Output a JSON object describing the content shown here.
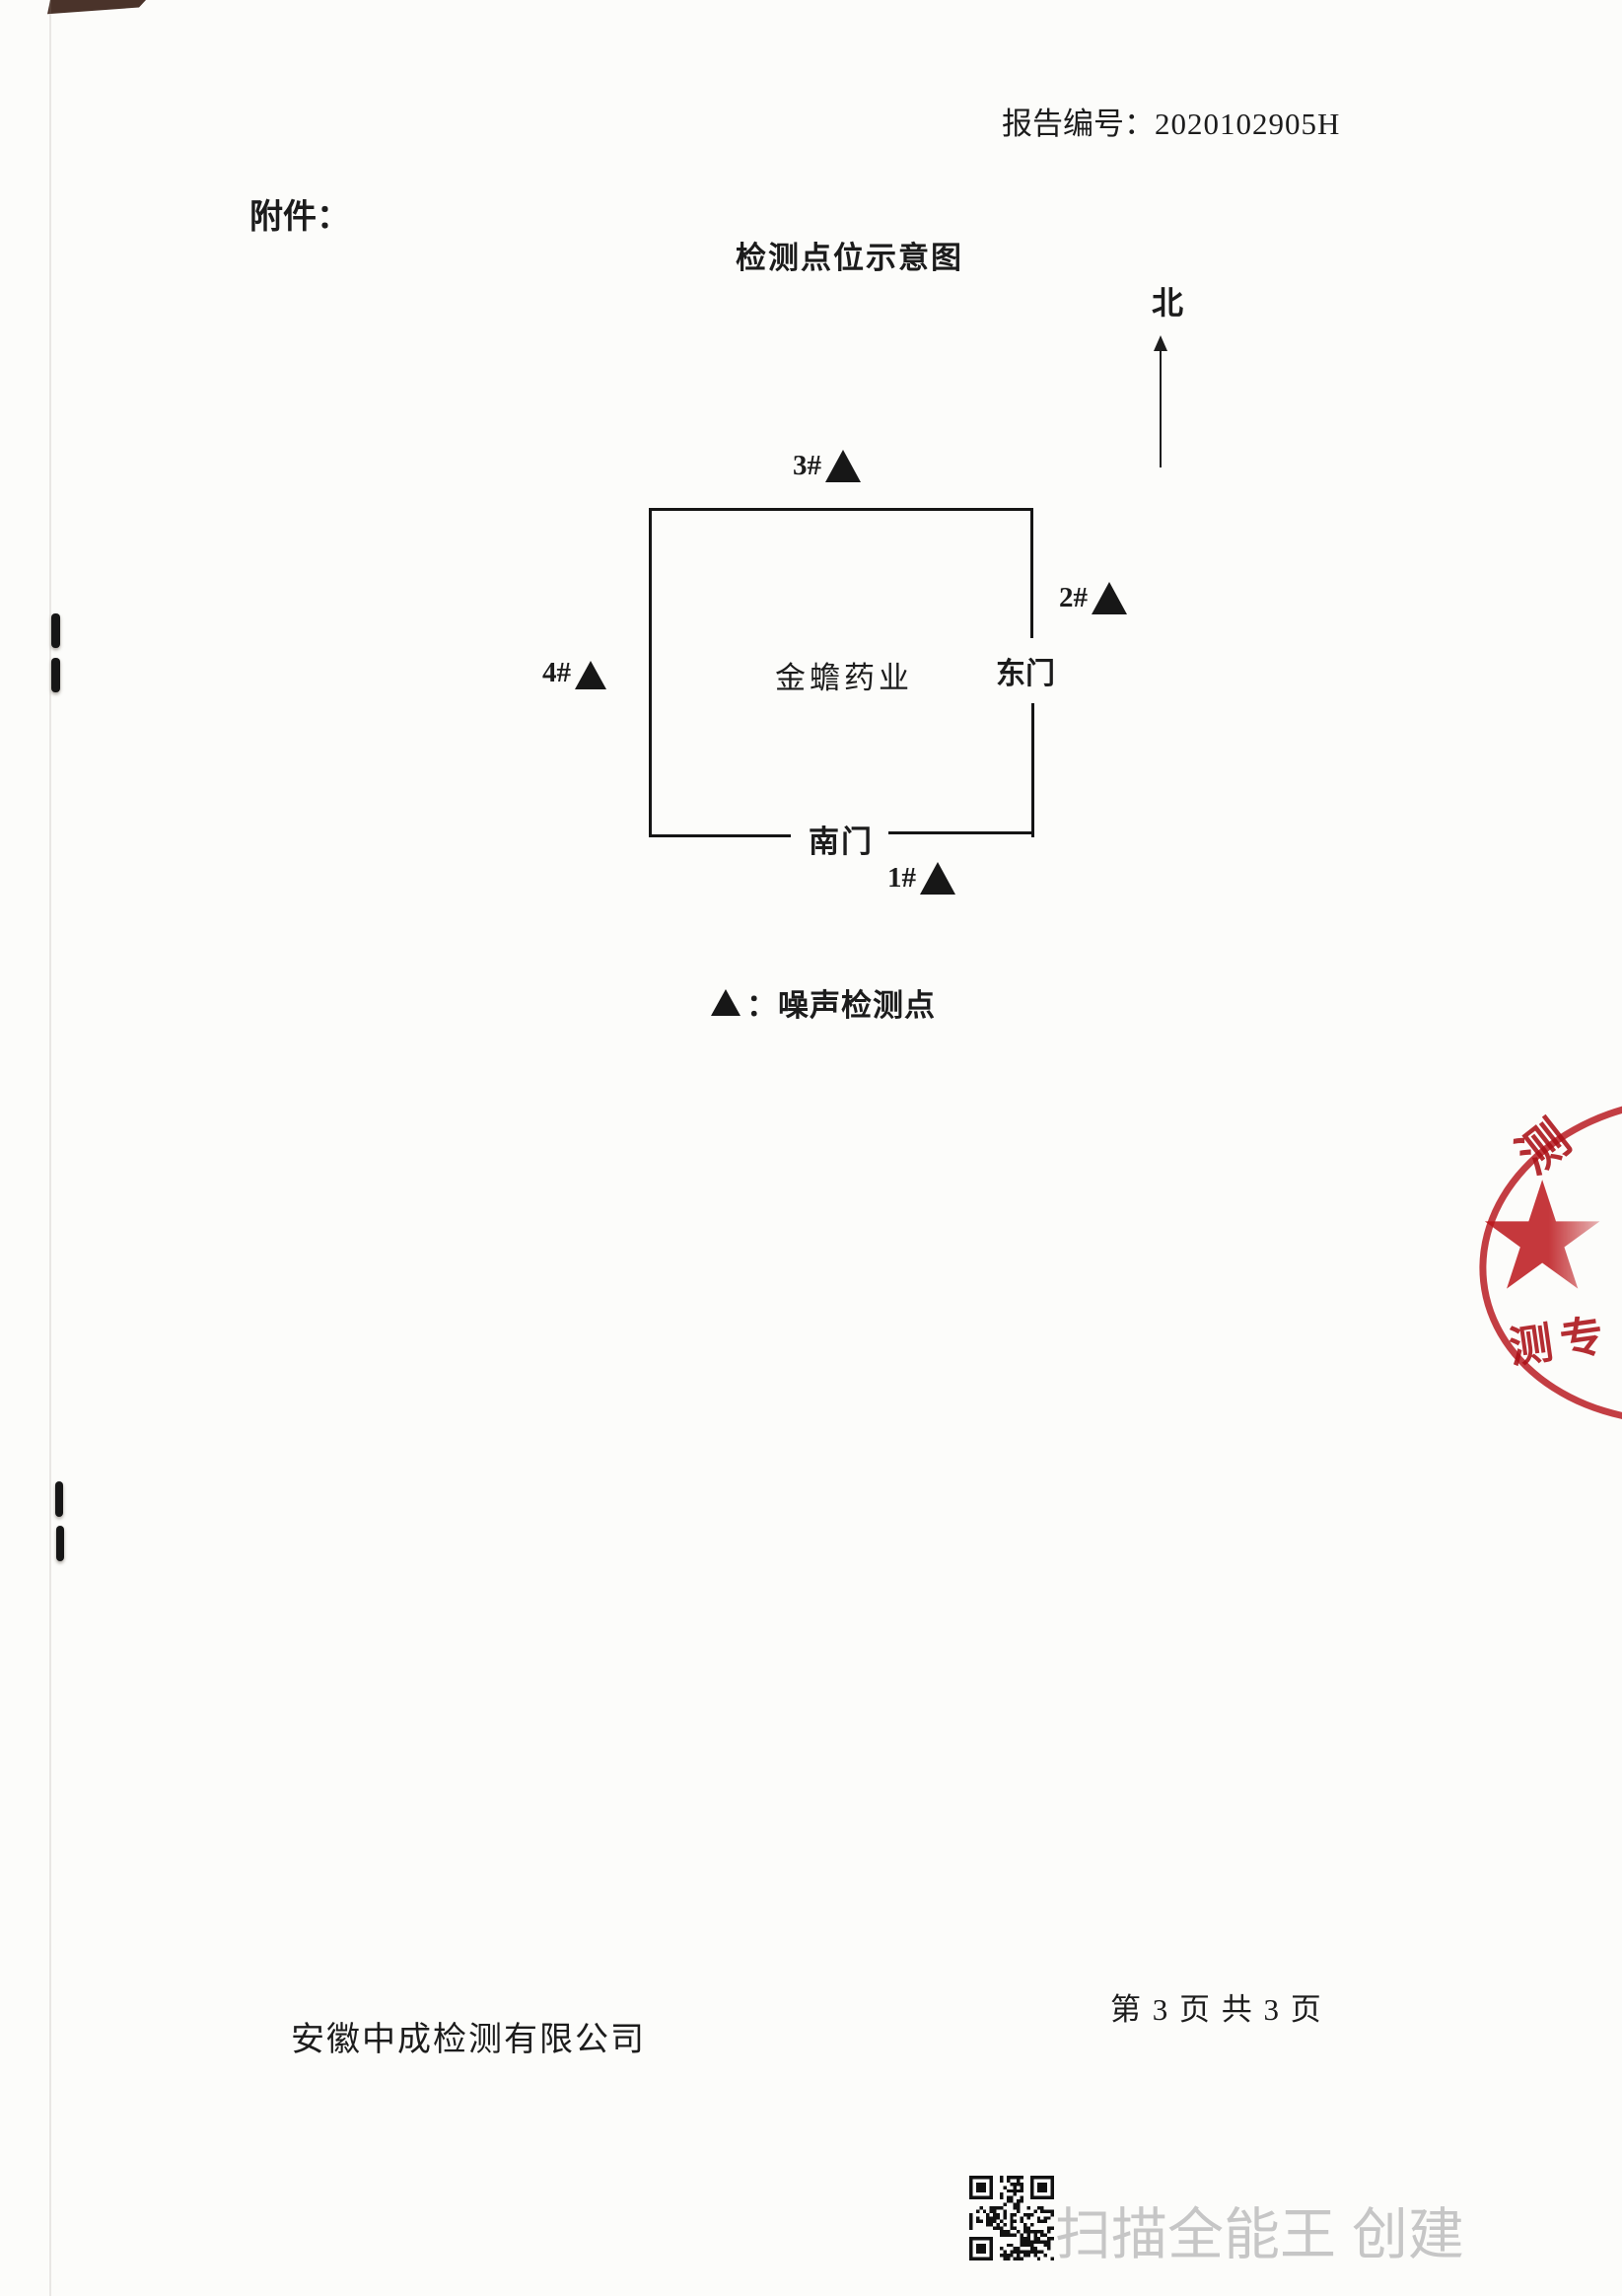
{
  "page": {
    "report_no_label": "报告编号：",
    "report_no_value": "2020102905H",
    "attachment_label": "附件：",
    "footer_company": "安徽中成检测有限公司",
    "page_info": "第 3 页 共 3 页"
  },
  "diagram": {
    "title": "检测点位示意图",
    "north_label": "北",
    "building_label": "金蟾药业",
    "east_gate_label": "东门",
    "south_gate_label": "南门",
    "markers": [
      {
        "label": "1#"
      },
      {
        "label": "2#"
      },
      {
        "label": "3#"
      },
      {
        "label": "4#"
      }
    ],
    "legend_text": "：噪声检测点"
  },
  "stamp": {
    "color": "#b6141b",
    "top_char": "测",
    "bottom_chars": "测专",
    "star": "★"
  },
  "watermark": {
    "text": "扫描全能王 创建",
    "color": "#c6c6c6"
  }
}
